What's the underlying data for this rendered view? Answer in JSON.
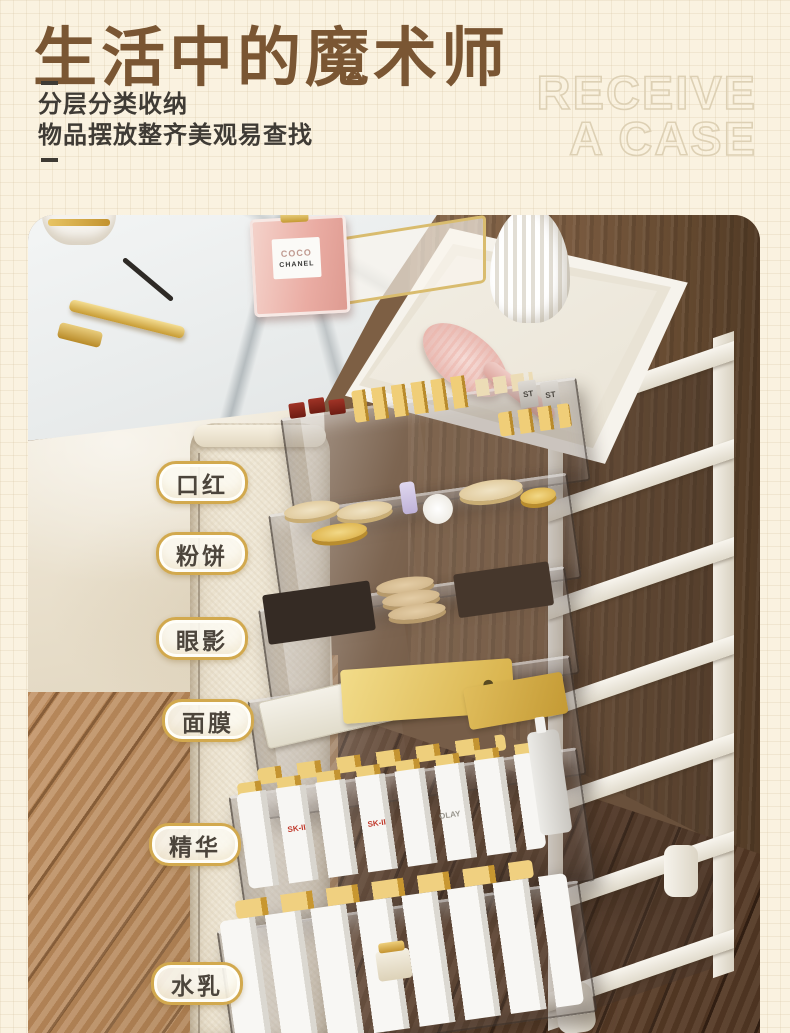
{
  "page": {
    "background_color": "#faf2e0",
    "title": "生活中的魔术师",
    "title_color": "#7a5633",
    "subtitle_line1": "分层分类收纳",
    "subtitle_line2": "物品摆放整齐美观易查找",
    "watermark_line1": "RECEIVE",
    "watermark_line2": "A CASE"
  },
  "photo": {
    "category_labels": [
      {
        "text": "口红"
      },
      {
        "text": "粉饼"
      },
      {
        "text": "眼影"
      },
      {
        "text": "面膜"
      },
      {
        "text": "精华"
      },
      {
        "text": "水乳"
      }
    ],
    "label_border_color": "#d2a94e",
    "perfume": {
      "line1": "COCO",
      "line2": "CHANEL"
    },
    "packet_text": "ST",
    "bottle_texts": {
      "skii": "SK-II",
      "olay": "OLAY"
    }
  }
}
